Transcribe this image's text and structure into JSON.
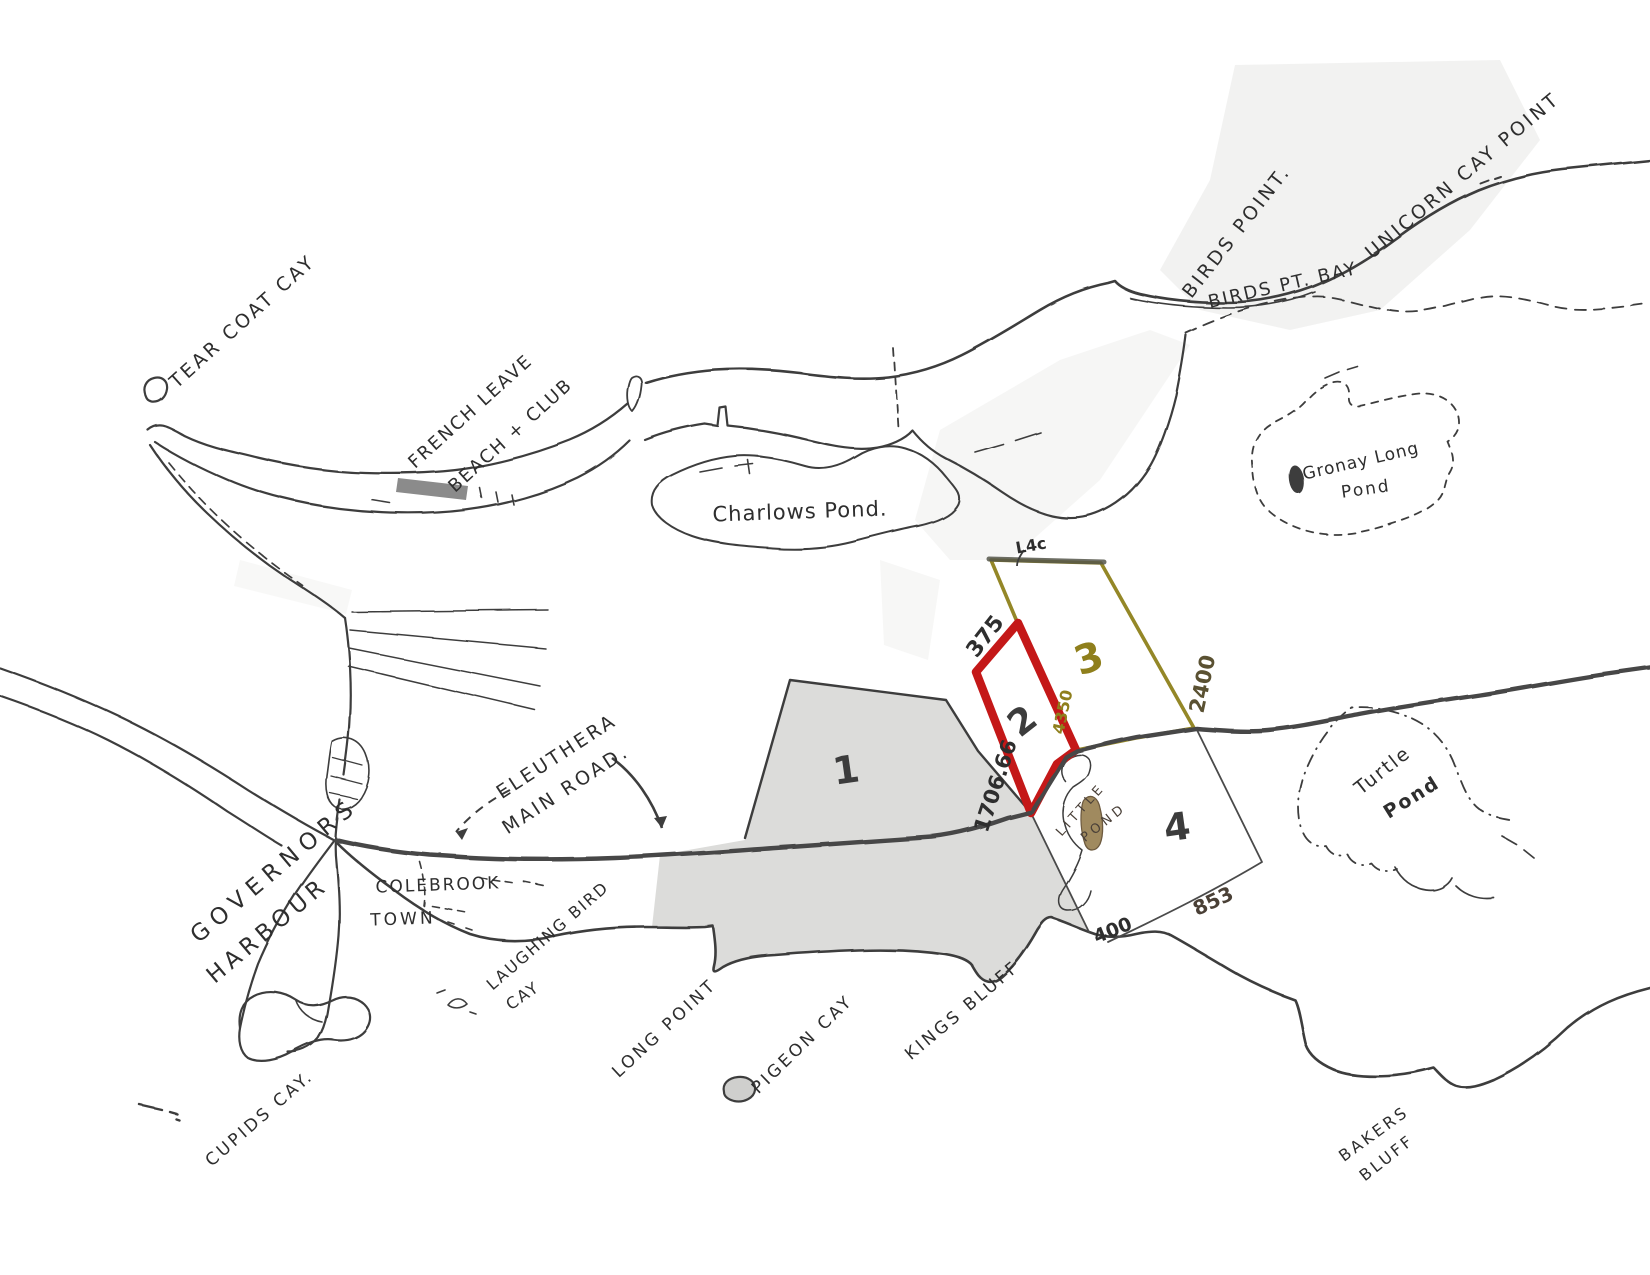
{
  "map": {
    "colors": {
      "ink": "#3d3d3d",
      "parcel2_outline": "#c41818",
      "parcel3_outline": "#948727",
      "land_shade": "#dcdcda",
      "little_pond_fill": "#a08a5f",
      "background": "#ffffff"
    },
    "labels": {
      "tear_coat_cay": "TEAR COAT CAY",
      "french_leave_line1": "FRENCH LEAVE",
      "french_leave_line2": "BEACH + CLUB",
      "charlows_pond": "Charlows Pond.",
      "birds_point": "BIRDS POINT.",
      "birds_pt_bay": "BIRDS PT. BAY",
      "unicorn_cay_point": "UNICORN CAY POINT",
      "gronay_long_pond_line1": "Gronay Long",
      "gronay_long_pond_line2": "Pond",
      "turtle_pond_line1": "Turtle",
      "turtle_pond_line2": "Pond",
      "eleuthera_main_road_line1": "ELEUTHERA",
      "eleuthera_main_road_line2": "MAIN ROAD.",
      "governors": "GOVERNORS",
      "harbour": "HARBOUR",
      "colebrook": "COLEBROOK",
      "town": "TOWN",
      "laughing_bird_line1": "LAUGHING BIRD",
      "laughing_bird_line2": "CAY",
      "long_point": "LONG POINT",
      "pigeon_cay": "PIGEON CAY",
      "kings_bluff": "KINGS BLUFF",
      "cupids_cay": "CUPIDS CAY.",
      "bakers_bluff_line1": "BAKERS",
      "bakers_bluff_line2": "BLUFF",
      "little_pond_line1": "LITTLE",
      "little_pond_line2": "POND"
    },
    "parcels": [
      {
        "number": "1"
      },
      {
        "number": "2"
      },
      {
        "number": "3"
      },
      {
        "number": "4"
      }
    ],
    "measurements": {
      "parcel2_nw_edge": "375",
      "parcel2_sw_edge": "1706.66",
      "parcel2_se_edge": "4350",
      "parcel3_top_edge": "L4c",
      "parcel3_east_edge": "2400",
      "parcel4_south": "853",
      "parcel4_west": "400"
    }
  }
}
